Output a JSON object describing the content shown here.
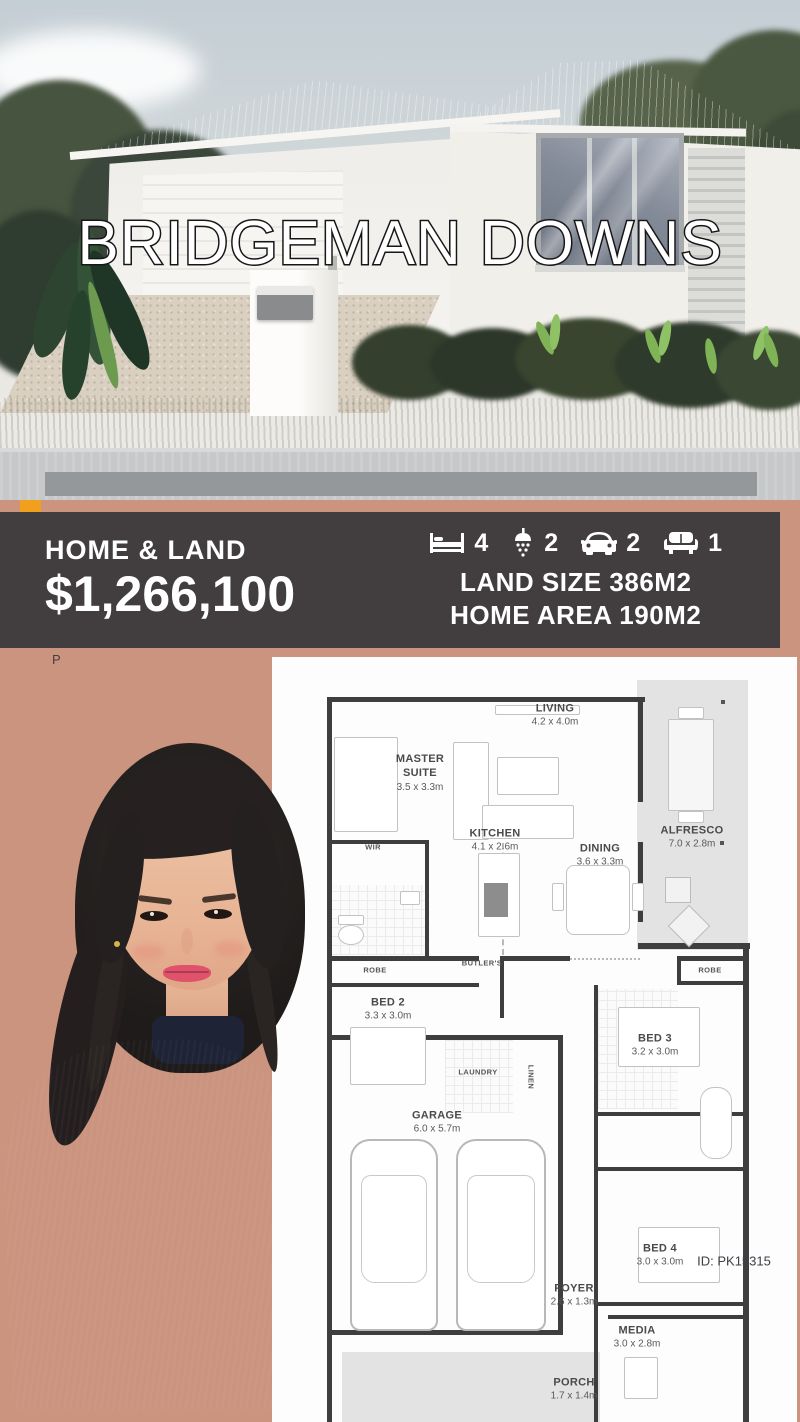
{
  "hero": {
    "title": "BRIDGEMAN DOWNS"
  },
  "info_band": {
    "label": "HOME & LAND",
    "price": "$1,266,100",
    "features": [
      {
        "icon": "bed-icon",
        "value": "4"
      },
      {
        "icon": "shower-icon",
        "value": "2"
      },
      {
        "icon": "car-icon",
        "value": "2"
      },
      {
        "icon": "sofa-icon",
        "value": "1"
      }
    ],
    "land_size": "LAND SIZE 386M2",
    "home_area": "HOME AREA 190M2"
  },
  "watermark": "P",
  "floor_plan": {
    "id_label": "ID: PK15315",
    "rooms": [
      {
        "name": "MASTER\nSUITE",
        "dims": "3.5 x 3.3m"
      },
      {
        "name": "LIVING",
        "dims": "4.2 x 4.0m"
      },
      {
        "name": "ALFRESCO",
        "dims": "7.0 x 2.8m"
      },
      {
        "name": "KITCHEN",
        "dims": "4.1 x 2.6m"
      },
      {
        "name": "DINING",
        "dims": "3.6 x 3.3m"
      },
      {
        "name": "BED 2",
        "dims": "3.3 x 3.0m"
      },
      {
        "name": "BED 3",
        "dims": "3.2 x 3.0m"
      },
      {
        "name": "GARAGE",
        "dims": "6.0 x 5.7m"
      },
      {
        "name": "BED 4",
        "dims": "3.0 x 3.0m"
      },
      {
        "name": "FOYER",
        "dims": "2.6 x 1.3m"
      },
      {
        "name": "MEDIA",
        "dims": "3.0 x 2.8m"
      },
      {
        "name": "PORCH",
        "dims": "1.7 x 1.4m"
      }
    ],
    "annotations": {
      "wir": "WIR",
      "robe_left": "ROBE",
      "butlers": "BUTLER'S",
      "robe_right": "ROBE",
      "laundry": "LAUNDRY",
      "linen": "LINEN"
    }
  },
  "colors": {
    "salmon": "#ca947f",
    "band": "#423e3f",
    "accent_orange": "#f0a01d",
    "plan_wall": "#3e3e3e",
    "text_light": "#ffffff"
  }
}
